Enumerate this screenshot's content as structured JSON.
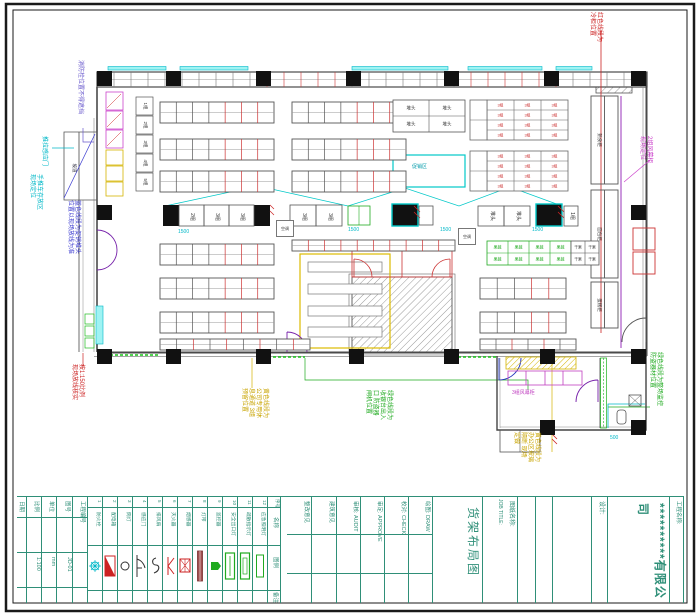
{
  "watermark": "＊＊＊＊＊",
  "plan": {
    "accent_colors": {
      "red": "#cc2222",
      "cyan": "#00b8c8",
      "magenta": "#cc44cc",
      "purple": "#6a5acd",
      "blue": "#3a3ad0",
      "yellow": "#c8a400",
      "green": "#1faa1f",
      "teal_titleblock": "#2f8f78",
      "column_black": "#111111"
    },
    "labels": {
      "counter_cells": [
        "2组",
        "3组",
        "3组",
        "3组",
        "3组",
        "堆头",
        "堆头",
        "1组"
      ],
      "shelf_tags": [
        "1组",
        "2组",
        "3组",
        "4组",
        "5组"
      ],
      "table_cell": "3组",
      "green_cell": "果蔬",
      "dry_cell": "干果",
      "box_label": "堆头",
      "counters_right": [
        "熟食柜",
        "面包柜",
        "蛋糕柜"
      ],
      "freezer_label": "3组风幕柜",
      "promo_area": "促销区",
      "ramp": "坡道",
      "ac_label": "空调",
      "dims": {
        "d1": "1500",
        "d2": "1500",
        "d3": "1500",
        "d4": "1500",
        "d500": "500"
      }
    }
  },
  "annotations": [
    {
      "id": "hydrant-note",
      "color": "#6a5acd",
      "lines": [
        "消防栓位置不得遮挡"
      ]
    },
    {
      "id": "door-note",
      "color": "#00b8c8",
      "lines": [
        "推拉感应门"
      ]
    },
    {
      "id": "cart-note",
      "color": "#00b8c8",
      "lines": [
        "手推车存放区",
        "现场定位"
      ]
    },
    {
      "id": "blue-note",
      "color": "#3a3ad0",
      "lines": [
        "蓝色线段为促销堆头",
        "位置以现场放线为准"
      ]
    },
    {
      "id": "scale-note",
      "color": "#cc2222",
      "lines": [
        "按1:150比例",
        "现场放线核实"
      ]
    },
    {
      "id": "yellow-note-1",
      "color": "#c8a400",
      "lines": [
        "黄色线段为",
        "公司专用休",
        "息通道 3组",
        "预留位置"
      ]
    },
    {
      "id": "green-note-1",
      "color": "#1faa1f",
      "lines": [
        "绿色线段为",
        "收银台出入",
        "口 防盗器",
        "闸机位置"
      ]
    },
    {
      "id": "yellow-note-2",
      "color": "#c8a400",
      "lines": [
        "黄色线段为",
        "办公区玻璃",
        "隔断 现场",
        "定做"
      ]
    },
    {
      "id": "green-note-2",
      "color": "#1faa1f",
      "lines": [
        "绿色线段为整场监控",
        "防盗器材位置"
      ]
    },
    {
      "id": "red-note-top",
      "color": "#cc2222",
      "lines": [
        "红色线段为",
        "冷柜位置"
      ]
    },
    {
      "id": "magenta-note",
      "color": "#cc44cc",
      "lines": [
        "2组风幕柜",
        "现场定位"
      ]
    }
  ],
  "titleblock": {
    "company": "**********有限公司",
    "project_name_label": "工程名称:",
    "design_label": "设计:",
    "drawing_name_label": "图纸名称:",
    "drawing_name_en": "JOB TITLE:",
    "drawing_title": "货架布局图",
    "fields": [
      "整改意见",
      "建筑意见",
      "审核: AUDIT",
      "审定: APPROVE",
      "校对: CHECK",
      "绘图: DRAW"
    ],
    "info_cols": [
      {
        "label": "日期",
        "value": ""
      },
      {
        "label": "比例",
        "value": "1:100"
      },
      {
        "label": "单位",
        "value": "mm"
      },
      {
        "label": "图号",
        "value": "JD-01"
      },
      {
        "label": "工程编号",
        "value": ""
      }
    ],
    "legend": {
      "no_label": "序号",
      "name_label": "名称",
      "symbol_label": "图例",
      "remark_label": "备注",
      "items": [
        {
          "num": "1",
          "name": "防火栓"
        },
        {
          "num": "2",
          "name": "配电箱"
        },
        {
          "num": "3",
          "name": "筒灯"
        },
        {
          "num": "4",
          "name": "感应门"
        },
        {
          "num": "5",
          "name": "排风扇"
        },
        {
          "num": "6",
          "name": "灭火器"
        },
        {
          "num": "7",
          "name": "烟感器"
        },
        {
          "num": "8",
          "name": "灯带"
        },
        {
          "num": "9",
          "name": "监控器"
        },
        {
          "num": "10",
          "name": "安全出口灯"
        },
        {
          "num": "11",
          "name": "疏散指示灯"
        },
        {
          "num": "12",
          "name": "应急照明灯"
        }
      ]
    }
  }
}
